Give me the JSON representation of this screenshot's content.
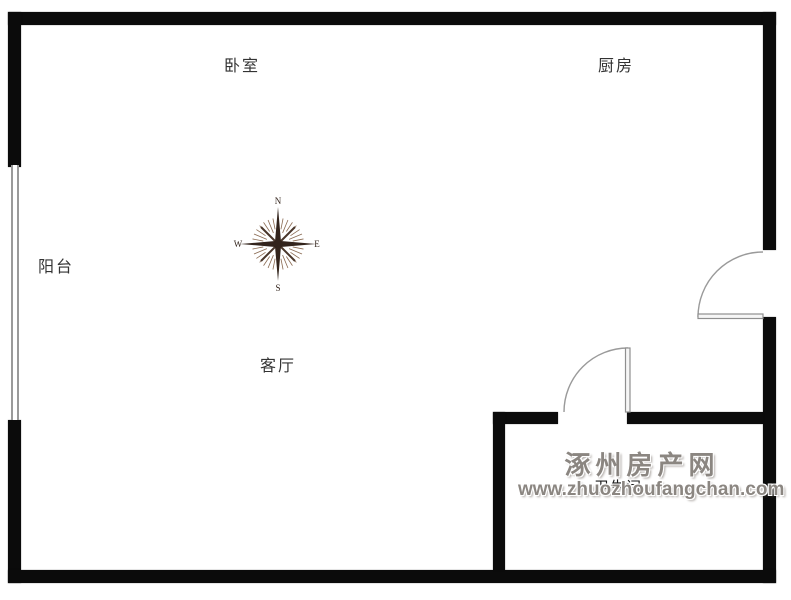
{
  "floorplan": {
    "rooms": {
      "bedroom": {
        "label": "卧室"
      },
      "kitchen": {
        "label": "厨房"
      },
      "balcony": {
        "label": "阳台"
      },
      "living_room": {
        "label": "客厅"
      },
      "bathroom": {
        "label": "卫生间"
      }
    },
    "compass": {
      "n": "N",
      "s": "S",
      "e": "E",
      "w": "W"
    },
    "watermark": {
      "site_name": "涿州房产网",
      "site_url": "www.zhuozhoufangchan.com"
    },
    "colors": {
      "wall": "#0b0b0b",
      "room_label": "#333333",
      "door_line": "#9a9a9a",
      "window_line": "#9a9a9a",
      "compass": "#33241c",
      "watermark": "#8b8681"
    }
  }
}
